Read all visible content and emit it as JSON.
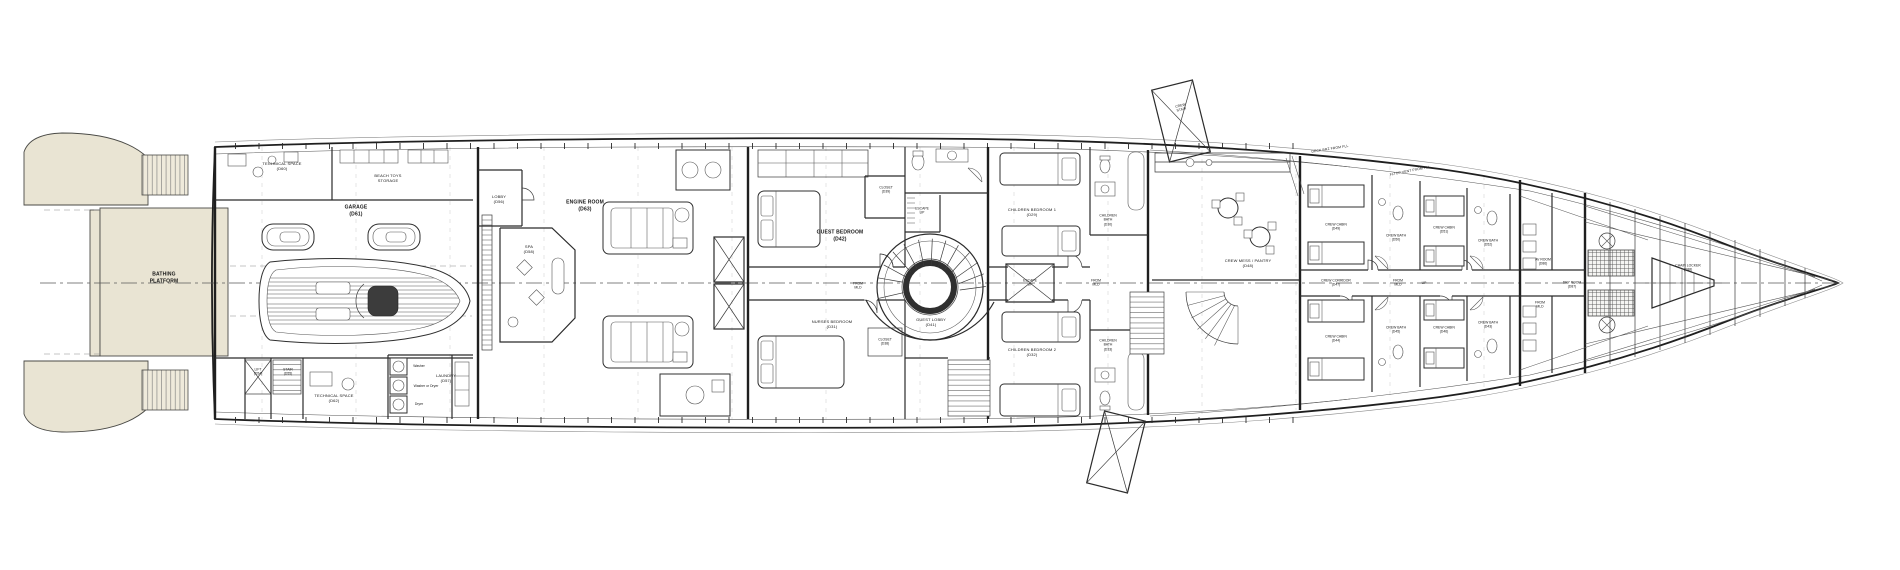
{
  "colors": {
    "paper": "#ffffff",
    "ink": "#1f1f1f",
    "teak_deck": "#e9e4d3",
    "teak_line": "#b3ab92",
    "construction_grid": "#cfcfcf",
    "dark_equipment": "#3c3c3c"
  },
  "labels": {
    "bathing_platform": "BATHING\nPLATFORM",
    "technical_space_top": "TECHNICAL SPACE\n(D60)",
    "beach_toys_storage": "BEACH TOYS\nSTORAGE",
    "garage": "GARAGE\n(D61)",
    "lift": "LIFT\n(D54)",
    "stair": "STAIR\n(D55)",
    "technical_space_bottom": "TECHNICAL SPACE\n(D62)",
    "laundry": "LAUNDRY\n(D57)",
    "washer": "Washer",
    "washer_or_dryer": "Washer or Dryer",
    "dryer": "Dryer",
    "lobby": "LOBBY\n(D56)",
    "engine_room": "ENGINE ROOM\n(D63)",
    "spa": "SPA\n(D58)",
    "guest_bedroom": "GUEST BEDROOM\n(D42)",
    "closet_fwd": "CLOSET\n(D39)",
    "escape_up_guest": "ESCAPE\nUP",
    "from_mld_guest": "FROM\nMLD",
    "guest_lobby": "GUEST LOBBY\n(D41)",
    "nurses_bedroom": "NURSES BEDROOM\n(D31)",
    "closet_aft": "CLOSET\n(D38)",
    "children_bedroom_1": "CHILDREN BEDROOM 1\n(D29)",
    "children_bath_1": "CHILDREN\nBATH\n(D30)",
    "escape_up_children": "ESCAPE\nUP",
    "from_mld_children": "FROM\nMLD",
    "children_bedroom_2": "CHILDREN BEDROOM 2\n(D32)",
    "children_bath_2": "CHILDREN\nBATH\n(D33)",
    "crew_stair": "CREW\nSTAIR",
    "crew_mess_pantry": "CREW MESS / PANTRY\n(D48)",
    "crew_corridor": "CREW CORRIDOR\n(D47)",
    "from_mld_crew": "FROM\nMLD",
    "up_crew": "UP",
    "crew_cabin_1": "CREW CABIN\n(D49)",
    "crew_bath_1": "CREW BATH\n(D50)",
    "crew_cabin_2": "CREW CABIN\n(D51)",
    "crew_bath_2": "CREW BATH\n(D52)",
    "crew_cabin_3": "CREW CABIN\n(D44)",
    "crew_bath_3": "CREW BATH\n(D45)",
    "crew_cabin_4": "CREW CABIN\n(D46)",
    "crew_bath_4": "CREW BATH\n(D43)",
    "av_room": "AV ROOM\n(D86)",
    "dry_room": "DRY ROOM\n(D87)",
    "from_mld_bow": "FROM\nMLD",
    "chain_locker": "CHAIN LOCKER\n(D88)",
    "deck_note_1": "DECK BRZ FROM FLL",
    "deck_note_2": "FLTOP VENT FROM FLL"
  }
}
